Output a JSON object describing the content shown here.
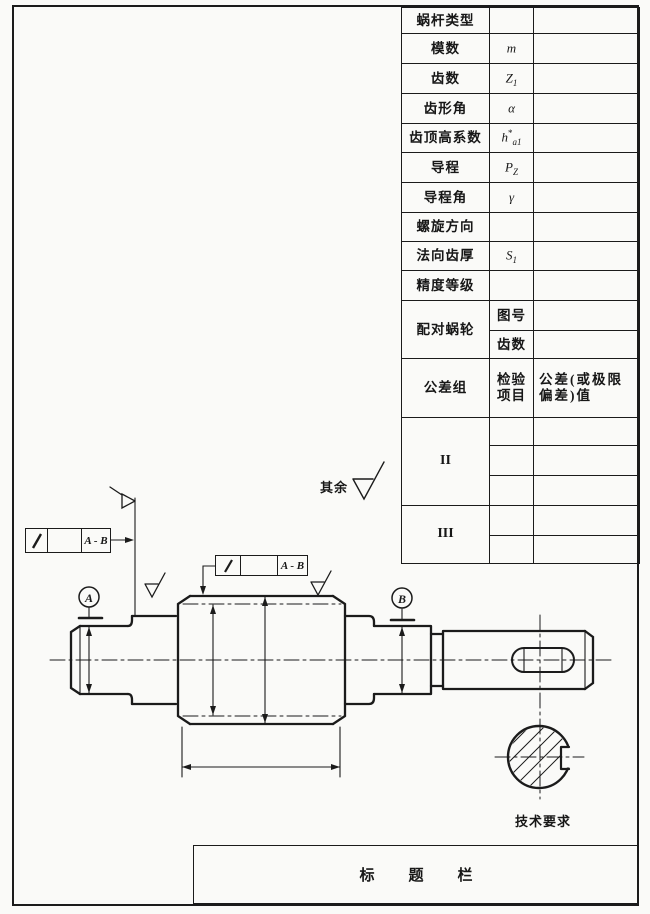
{
  "spec_table": {
    "rows": [
      {
        "label": "蜗杆类型"
      },
      {
        "label": "模数",
        "sym": {
          "base": "m",
          "sup": "",
          "sub": ""
        }
      },
      {
        "label": "齿数",
        "sym": {
          "base": "Z",
          "sup": "",
          "sub": "1"
        }
      },
      {
        "label": "齿形角",
        "sym": {
          "base": "α",
          "sup": "",
          "sub": ""
        }
      },
      {
        "label": "齿顶高系数",
        "sym": {
          "base": "h",
          "sup": "*",
          "sub": "a1"
        }
      },
      {
        "label": "导程",
        "sym": {
          "base": "P",
          "sup": "",
          "sub": "Z"
        }
      },
      {
        "label": "导程角",
        "sym": {
          "base": "γ",
          "sup": "",
          "sub": ""
        }
      },
      {
        "label": "螺旋方向",
        "sym": {
          "base": "",
          "sup": "",
          "sub": ""
        }
      },
      {
        "label": "法向齿厚",
        "sym": {
          "base": "S",
          "sup": "",
          "sub": "1"
        }
      },
      {
        "label": "精度等级",
        "sym": {
          "base": "",
          "sup": "",
          "sub": ""
        }
      },
      {
        "label": "配对蜗轮",
        "sub_rows": [
          "图号",
          "齿数"
        ]
      },
      {
        "label": "公差组",
        "mid": [
          "检验",
          "项目"
        ],
        "right": [
          "公差(或极限",
          "偏差)值"
        ]
      },
      {
        "label": "II"
      },
      {
        "label": "III"
      }
    ]
  },
  "annotations": {
    "datum_a": "A",
    "datum_b": "B",
    "fcf_ref_left": "A - B",
    "fcf_ref_top": "A - B",
    "rest_label": "其余",
    "tech_req": "技术要求",
    "title_bar": "标题栏"
  },
  "colors": {
    "ink": "#1b1b1b",
    "paper": "#fafaf8"
  }
}
